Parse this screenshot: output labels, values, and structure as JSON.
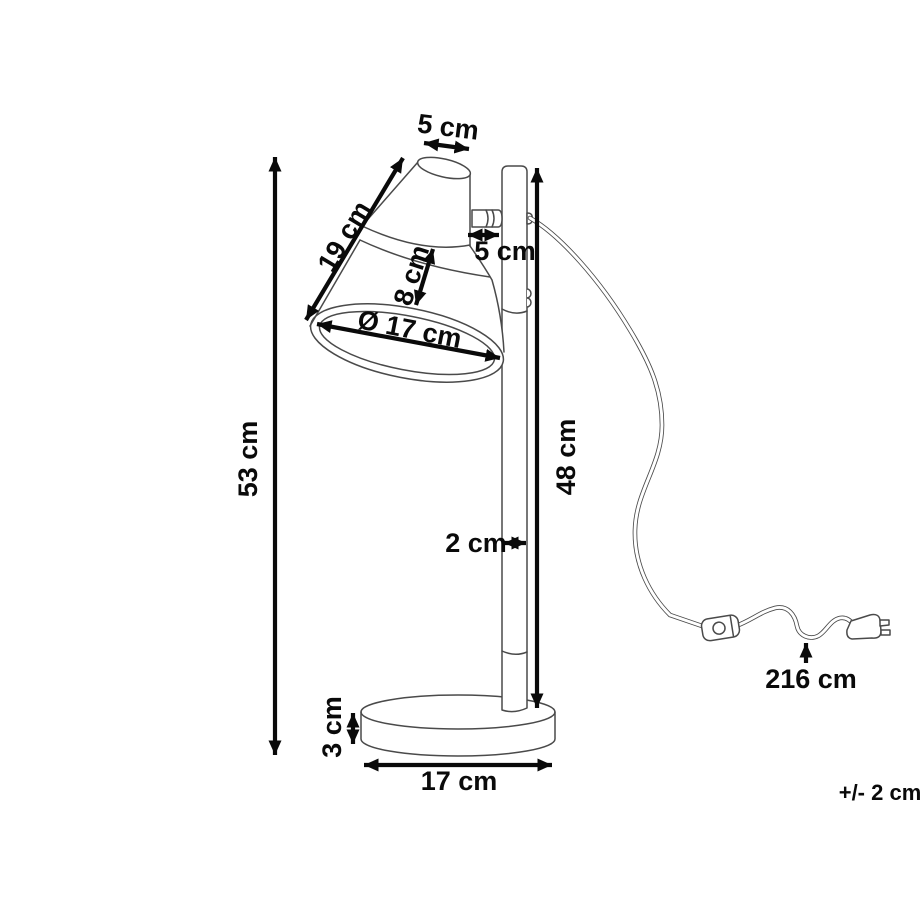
{
  "figure": {
    "type": "product-dimension-diagram",
    "subject": "desk lamp line drawing",
    "units": "cm",
    "colors": {
      "background": "#ffffff",
      "drawing_line": "#4a4a4a",
      "dimension_line": "#0a0a0a"
    },
    "labels": {
      "shade_top_width": "5 cm",
      "shade_slant_length": "19 cm",
      "shade_depth": "8 cm",
      "shade_opening_diameter": "Ø 17 cm",
      "arm_length": "5 cm",
      "total_height": "53 cm",
      "pole_height": "48 cm",
      "pole_diameter": "2 cm",
      "base_height": "3 cm",
      "base_diameter": "17 cm",
      "cable_length": "216 cm",
      "tolerance": "+/- 2 cm"
    }
  }
}
